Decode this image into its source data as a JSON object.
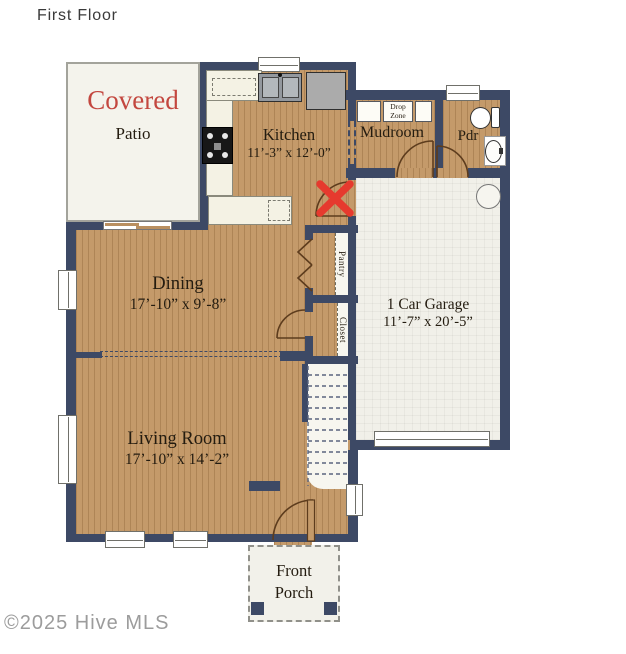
{
  "title": "First Floor",
  "watermark": "©2025 Hive MLS",
  "colors": {
    "wall": "#3d4965",
    "wood": "#c49a6a",
    "red_x": "#e63a2e",
    "covered_red": "#c3473f",
    "garage_floor": "#f1f0e9",
    "counter": "#f4f2e4"
  },
  "rooms": {
    "patio": {
      "line1": "Covered",
      "line2": "Patio"
    },
    "kitchen": {
      "name": "Kitchen",
      "dims": "11’-3” x 12’-0”"
    },
    "mudroom": {
      "name": "Mudroom"
    },
    "drop_zone": {
      "line1": "Drop",
      "line2": "Zone"
    },
    "powder": {
      "name": "Pdr"
    },
    "garage": {
      "name": "1 Car Garage",
      "dims": "11’-7” x 20’-5”"
    },
    "dining": {
      "name": "Dining",
      "dims": "17’-10” x 9’-8”"
    },
    "living": {
      "name": "Living Room",
      "dims": "17’-10” x 14’-2”"
    },
    "pantry": {
      "name": "Pantry"
    },
    "closet": {
      "name": "Closet"
    },
    "porch": {
      "line1": "Front",
      "line2": "Porch"
    }
  }
}
